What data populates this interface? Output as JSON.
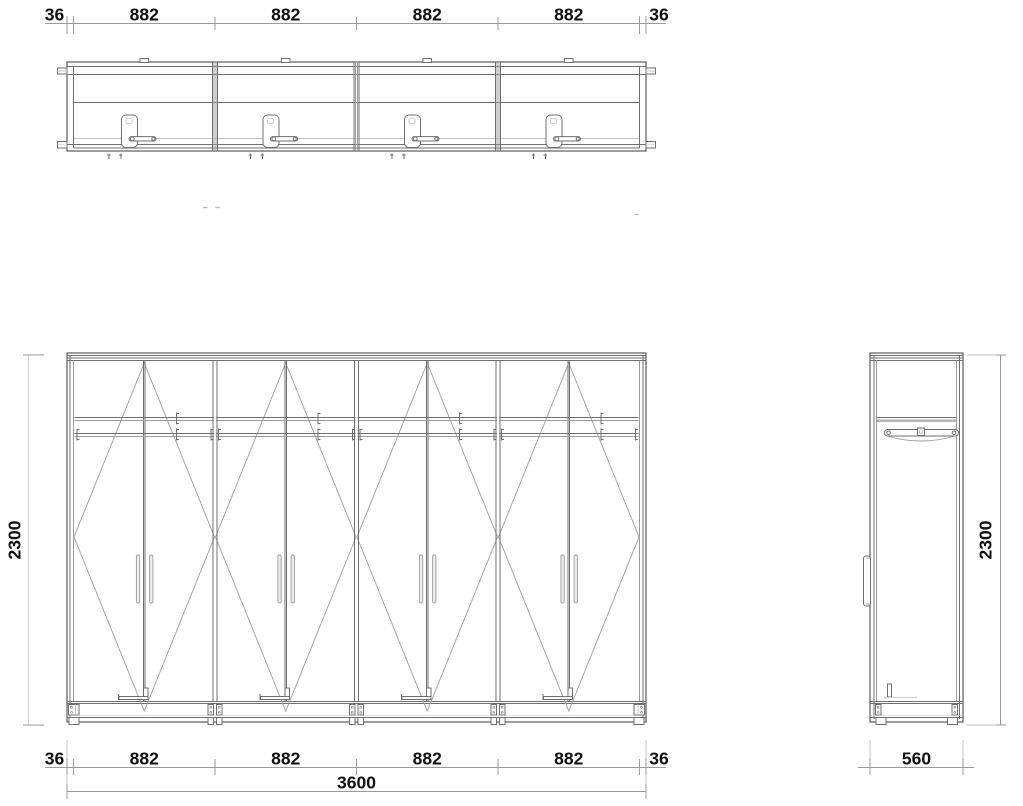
{
  "colors": {
    "bg": "#ffffff",
    "line-strong": "#3a3a3a",
    "line-med": "#6f6f6f",
    "line-light": "#9c9c9c",
    "line-faint": "#c4c4c4",
    "dim-line": "#9a9a9a",
    "text": "#111111",
    "handle-fill": "#ededed"
  },
  "dimensions": {
    "top": {
      "left_side": "36",
      "segments": [
        "882",
        "882",
        "882",
        "882"
      ],
      "right_side": "36"
    },
    "bottom": {
      "left_side": "36",
      "segments": [
        "882",
        "882",
        "882",
        "882"
      ],
      "right_side": "36",
      "total_width": "3600"
    },
    "front_height": "2300",
    "side_height": "2300",
    "side_depth": "560"
  }
}
